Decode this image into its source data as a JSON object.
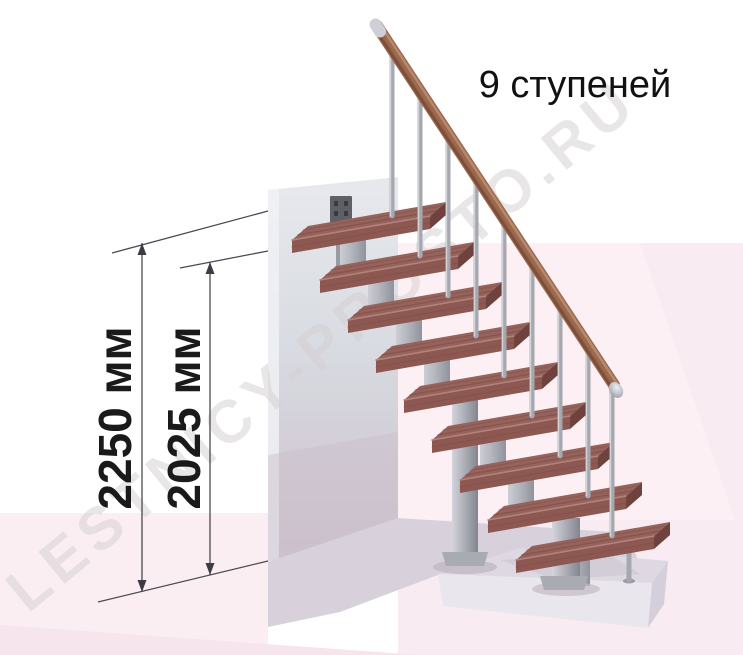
{
  "title": "9 ступеней",
  "watermark": "LESTNICY-PROSTO.RU",
  "dimensions": {
    "total": {
      "label": "2250 мм"
    },
    "flight": {
      "label": "2025 мм"
    }
  },
  "staircase": {
    "step_count": 9,
    "parts": [
      "treads",
      "central-stringer-modules",
      "support-columns",
      "balusters",
      "handrail",
      "wall-mount-bracket"
    ]
  },
  "colors": {
    "tread_wood": "#96635c",
    "tread_wood_dark": "#7c4a44",
    "handrail_wood": "#9b6950",
    "metal": "#aeb0b8",
    "wall_gray": "#dadde2",
    "floor_pink": "#fbeef3",
    "platform_gray": "#ddd8e1",
    "dimension_line": "#4a4a52",
    "text_black": "#1a1a1a"
  }
}
